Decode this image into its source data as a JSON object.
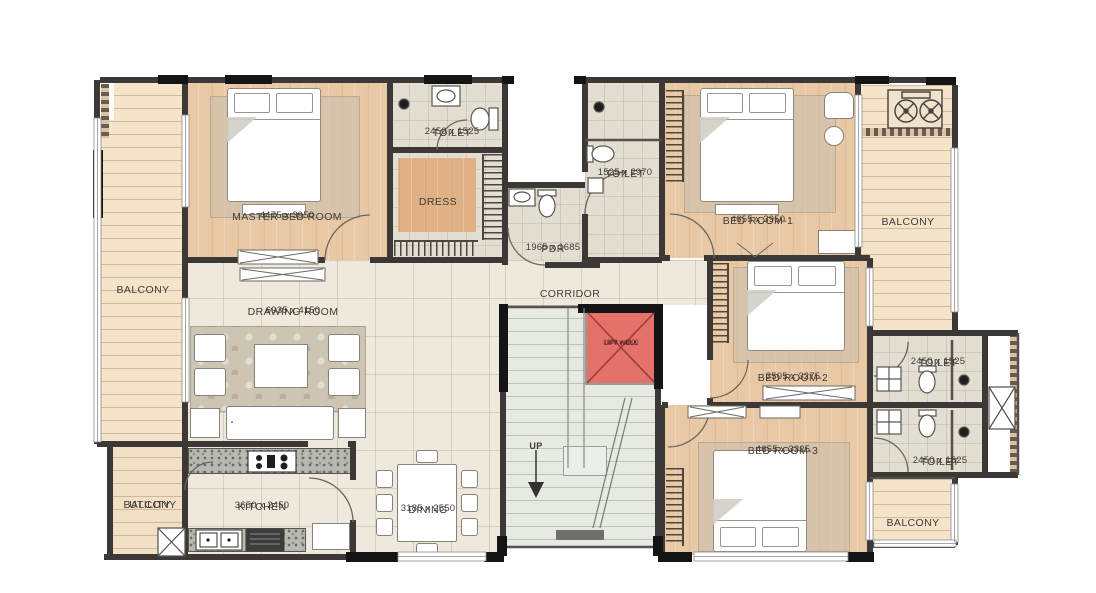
{
  "palette": {
    "wall": "#3b3835",
    "wood": "#e9c9a5",
    "tile": "#eee9dc",
    "plank": "#f5e4ca",
    "bath": "#e3ded2",
    "stairs": "#e6eae3",
    "lift_red": "#e4716a",
    "carpet": "#cdc5b3",
    "granite": "#b9b9b2"
  },
  "rooms": {
    "balcony_left": {
      "label": "BALCONY"
    },
    "utility_balcony": {
      "label_line1": "UTILITY",
      "label_line2": "BALCONY"
    },
    "master_bedroom": {
      "label": "MASTER BED ROOM",
      "dims": "4475 x 3950"
    },
    "toilet_master": {
      "label": "TOILET",
      "dims": "2450 x 1525"
    },
    "dress": {
      "label": "DRESS"
    },
    "pdr": {
      "label": "PDR",
      "dims": "1965 x 1685"
    },
    "toilet_common": {
      "label": "TOILET",
      "dims": "1525 x 2970"
    },
    "bedroom_1": {
      "label": "BED ROOM-1",
      "dims": "4655 x 3950"
    },
    "balcony_right_top": {
      "label": "BALCONY"
    },
    "drawing_room": {
      "label": "DRAWING ROOM",
      "dims": "6935 x 4150"
    },
    "corridor": {
      "label": "CORRIDOR"
    },
    "lift_well": {
      "label": "LIFT WELL",
      "dims": "1800 x 1800"
    },
    "stairs": {
      "label": "UP"
    },
    "bedroom_2": {
      "label": "BED ROOM-2",
      "dims": "3505 x 3275"
    },
    "toilet_bedroom_2": {
      "label": "TOILET",
      "dims": "2450 x 1525"
    },
    "bedroom_3": {
      "label": "BED ROOM-3",
      "dims": "4655 x 3325"
    },
    "toilet_bedroom_3": {
      "label": "TOILET",
      "dims": "2450 x 1525"
    },
    "balcony_right_bottom": {
      "label": "BALCONY"
    },
    "kitchen": {
      "label": "KITCHEN",
      "dims": "3650 x 2450"
    },
    "dining": {
      "label": "DINING",
      "dims": "3185 x 2550"
    }
  },
  "fixtures": {
    "fan": "ac-fan-icon",
    "wc": "toilet-wc-icon",
    "basin": "wash-basin-icon",
    "shower": "shower-head-icon",
    "hob": "gas-hob-icon",
    "sink": "kitchen-sink-icon",
    "duct": "duct-shaft-icon"
  }
}
